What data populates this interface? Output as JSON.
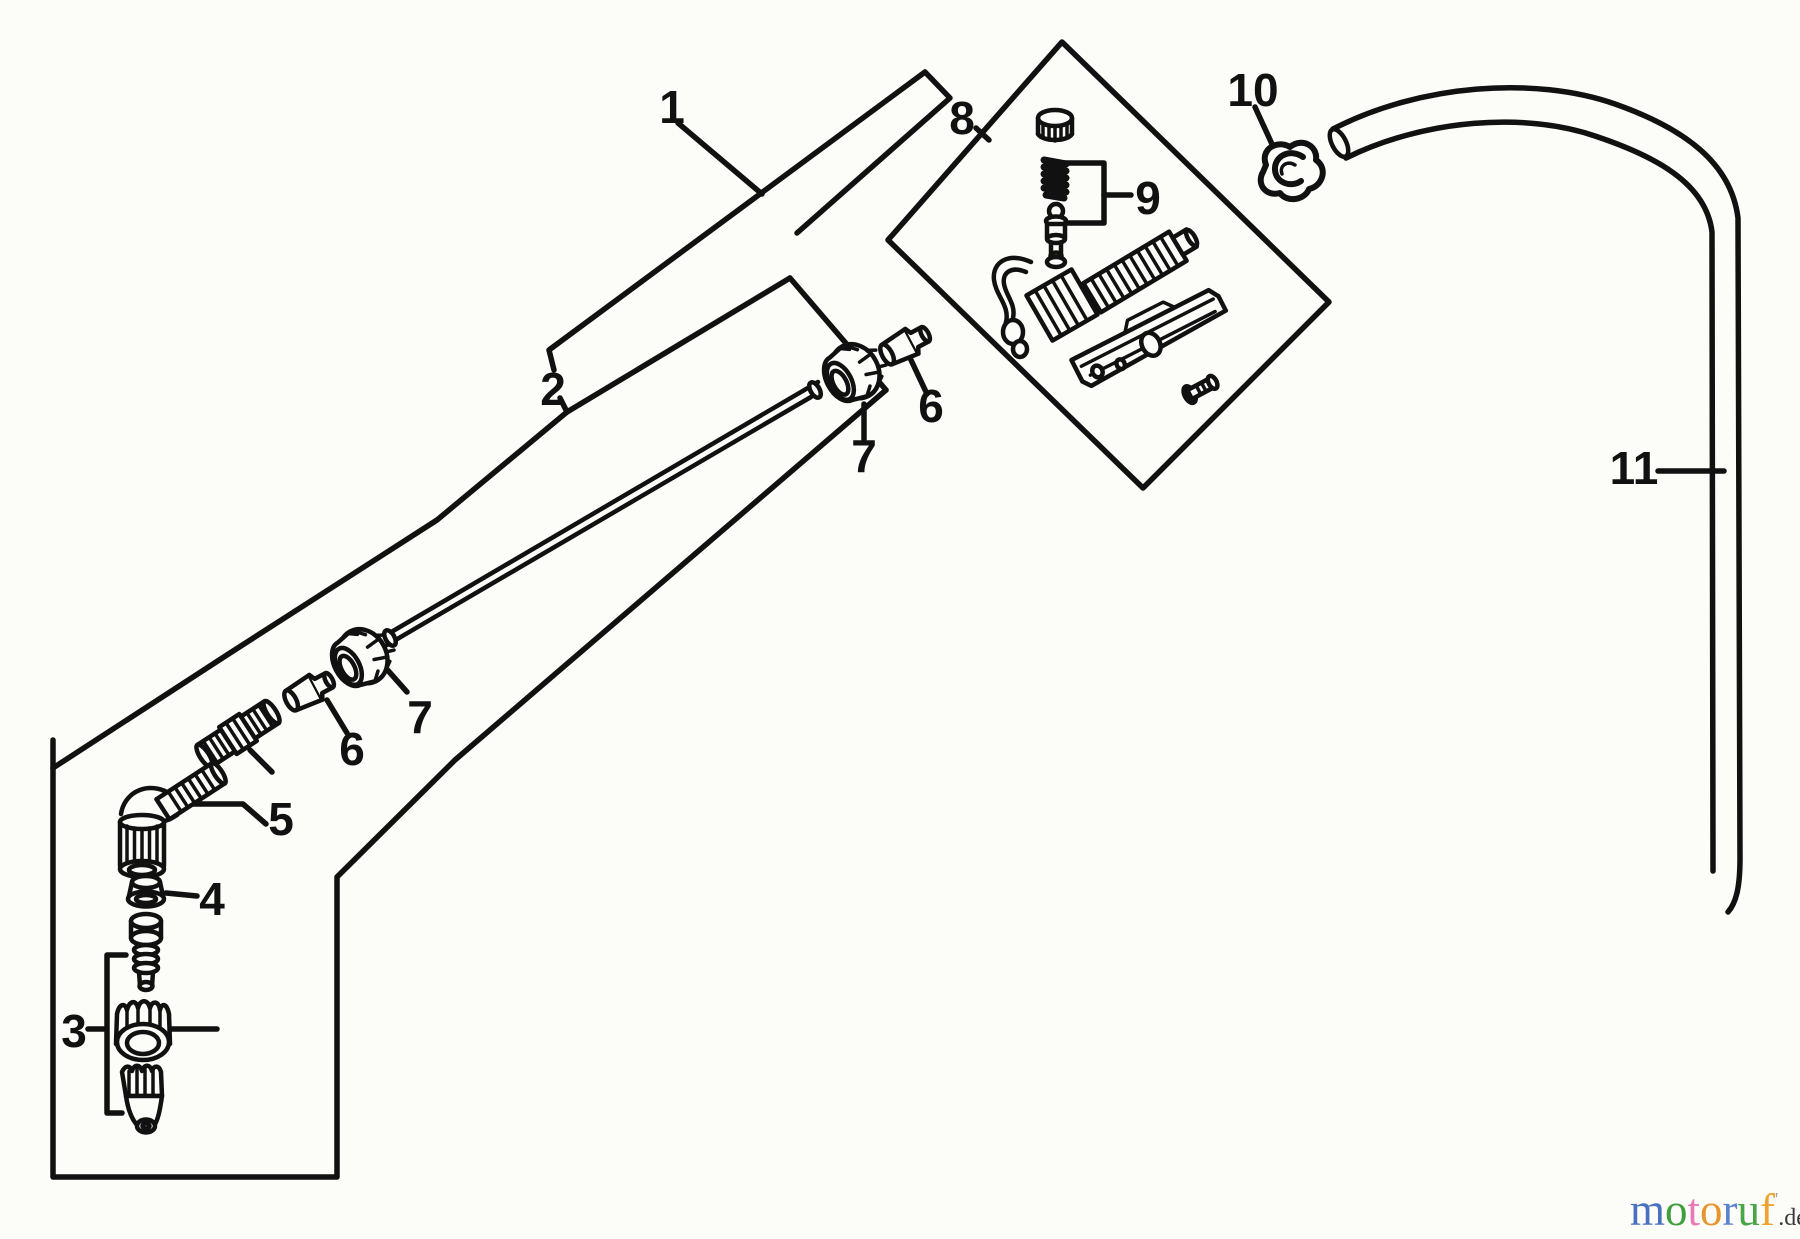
{
  "diagram": {
    "background": "#fcfcf9",
    "ink": "#111111",
    "part_labels": [
      {
        "text": "1",
        "x": 672,
        "y": 107
      },
      {
        "text": "2",
        "x": 553,
        "y": 389
      },
      {
        "text": "3",
        "x": 74,
        "y": 1031
      },
      {
        "text": "4",
        "x": 212,
        "y": 899
      },
      {
        "text": "5",
        "x": 281,
        "y": 819
      },
      {
        "text": "6",
        "x": 931,
        "y": 406
      },
      {
        "text": "7",
        "x": 864,
        "y": 456
      },
      {
        "text": "6",
        "x": 352,
        "y": 749
      },
      {
        "text": "7",
        "x": 420,
        "y": 717
      },
      {
        "text": "8",
        "x": 962,
        "y": 118
      },
      {
        "text": "9",
        "x": 1148,
        "y": 198
      },
      {
        "text": "10",
        "x": 1253,
        "y": 90
      },
      {
        "text": "11",
        "x": 1634,
        "y": 468
      }
    ],
    "watermark": {
      "letters": [
        {
          "ch": "m",
          "color": "#4a70c0"
        },
        {
          "ch": "o",
          "color": "#3f9f3f"
        },
        {
          "ch": "t",
          "color": "#e87ab8"
        },
        {
          "ch": "o",
          "color": "#e8952f"
        },
        {
          "ch": "r",
          "color": "#5b83cf"
        },
        {
          "ch": "u",
          "color": "#4aa44a"
        },
        {
          "ch": "f",
          "color": "#eda32e"
        }
      ],
      "mark": "'",
      "mark_color": "#9a9a9a",
      "suffix": ".de",
      "suffix_color": "#3a3a3a"
    }
  }
}
